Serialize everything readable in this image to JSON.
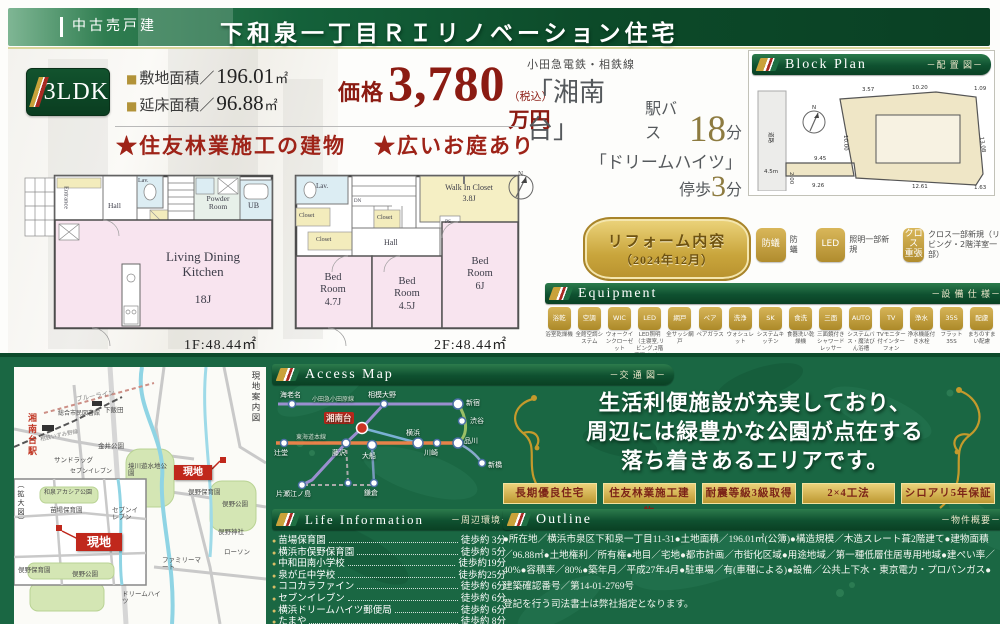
{
  "header": {
    "category": "中古売戸建",
    "title": "下和泉一丁目ＲＩリノベーション住宅"
  },
  "summary": {
    "layout": "3LDK",
    "bullet": "■",
    "land_label": "敷地面積／",
    "land_value": "196.01",
    "land_unit": "㎡",
    "floor_label": "延床面積／",
    "floor_value": "96.88",
    "floor_unit": "㎡",
    "price_label": "価格",
    "price_value": "3,780",
    "price_tax": "（税込）",
    "price_unit": "万円",
    "feature1": "★住友林業施工の建物",
    "feature2": "★広いお庭あり",
    "rail_line": "小田急電鉄・相鉄線",
    "station_name": "「湘南台」",
    "station_mode": "駅バス",
    "station_min": "18",
    "station_unit": "分",
    "bus_name": "「ドリームハイツ」",
    "bus_mode": "停歩",
    "bus_min": "3",
    "bus_unit": "分"
  },
  "block_plan": {
    "title": "Block Plan",
    "subtitle": "－配 置 図－",
    "road": "道路",
    "road_width": "4.5m",
    "compass": "N",
    "dims": {
      "top1": "3.57",
      "top2": "10.20",
      "top3": "1.09",
      "right": "13.08",
      "bottom1": "1.63",
      "bottom2": "12.61",
      "bottom3": "9.26",
      "flag_top": "9.45",
      "flag_left": "2.00",
      "left": "10.00"
    }
  },
  "floor1": {
    "area": "1F:48.44㎡",
    "rooms": {
      "entrance": "Entrance",
      "hall": "Hall",
      "lav": "Lav.",
      "powder": "Powder Room",
      "ub": "UB",
      "ldk": "Living Dining Kitchen",
      "ldk_size": "18J"
    }
  },
  "floor2": {
    "area": "2F:48.44㎡",
    "rooms": {
      "lav": "Lav.",
      "closet1": "Closet",
      "closet2": "Closet",
      "closet3": "Closet",
      "dn": "DN",
      "hall": "Hall",
      "wic": "Walk In Closet",
      "wic_size": "3.8J",
      "ps": "PS",
      "bed1": "Bed Room",
      "bed1_size": "4.7J",
      "bed2": "Bed Room",
      "bed2_size": "4.5J",
      "bed3": "Bed Room",
      "bed3_size": "6J"
    }
  },
  "reform": {
    "badge_title": "リフォーム内容",
    "badge_date": "（2024年12月）",
    "items": [
      {
        "glyph": "防蟻",
        "label": "防蟻"
      },
      {
        "glyph": "LED",
        "label": "照明一部新規"
      },
      {
        "glyph": "クロス 重張",
        "label": "クロス一部新規（リビング・2階洋室一部）"
      }
    ]
  },
  "equipment": {
    "title": "Equipment",
    "subtitle": "－設 備 仕 様－",
    "items": [
      {
        "glyph": "浴乾",
        "label": "浴室乾燥機"
      },
      {
        "glyph": "空調",
        "label": "全館空調システム"
      },
      {
        "glyph": "WIC",
        "label": "ウォークインクローゼット"
      },
      {
        "glyph": "LED",
        "label": "LED照明（主寝室,リビング,2階廊下,トイレ,キッチン,洗面所）"
      },
      {
        "glyph": "網戸",
        "label": "全サッシ網戸"
      },
      {
        "glyph": "ペア",
        "label": "ペアガラス"
      },
      {
        "glyph": "洗浄",
        "label": "ウォシュレット"
      },
      {
        "glyph": "SK",
        "label": "システムキッチン"
      },
      {
        "glyph": "食洗",
        "label": "食器洗い乾燥機"
      },
      {
        "glyph": "三面",
        "label": "三面鏡付きシャワードレッサー"
      },
      {
        "glyph": "AUTO",
        "label": "システムバス・魔法びん浴槽"
      },
      {
        "glyph": "TV",
        "label": "TVモニター付インターフォン"
      },
      {
        "glyph": "浄水",
        "label": "浄水機能付き水栓"
      },
      {
        "glyph": "35S",
        "label": "フラット35S"
      },
      {
        "glyph": "配慮",
        "label": "まちのすまい配慮"
      }
    ]
  },
  "access_map": {
    "title": "Access Map",
    "subtitle": "－交 通 図－",
    "line_labels": {
      "odakyu": "小田急小田原線",
      "tokaido": "東海道本線"
    },
    "stations": {
      "ebina": "海老名",
      "sagamiono": "相模大野",
      "shinjuku": "新宿",
      "shibuya": "渋谷",
      "shonandai": "湘南台",
      "tsujido": "辻堂",
      "fujisawa": "藤沢",
      "ofuna": "大船",
      "yokohama": "横浜",
      "kawasaki": "川崎",
      "shinagawa": "品川",
      "shimbashi": "新橋",
      "katase": "片瀬江ノ島",
      "kamakura": "鎌倉"
    }
  },
  "message": {
    "line1": "生活利便施設が充実しており、",
    "line2": "周辺には緑豊かな公園が点在する",
    "line3": "落ち着きあるエリアです。"
  },
  "cert_badges": [
    "長期優良住宅",
    "住友林業施工建物",
    "耐震等級3級取得",
    "2×4工法",
    "シロアリ5年保証"
  ],
  "life_info": {
    "title": "Life Information",
    "subtitle": "－周辺環境－",
    "items": [
      {
        "name": "苗場保育園",
        "time": "徒歩約 3分"
      },
      {
        "name": "横浜市俣野保育園",
        "time": "徒歩約 5分"
      },
      {
        "name": "中和田南小学校",
        "time": "徒歩約19分"
      },
      {
        "name": "泉が丘中学校",
        "time": "徒歩約25分"
      },
      {
        "name": "ココカラファイン",
        "time": "徒歩約 6分"
      },
      {
        "name": "セブンイレブン",
        "time": "徒歩約 6分"
      },
      {
        "name": "横浜ドリームハイツ郵便局",
        "time": "徒歩約 6分"
      },
      {
        "name": "たまや",
        "time": "徒歩約 8分"
      }
    ]
  },
  "outline": {
    "title": "Outline",
    "subtitle": "－物件概要－",
    "text": "●所在地／横浜市泉区下和泉一丁目11-31●土地面積／196.01㎡(公簿)●構造規模／木造スレート葺2階建て●建物面積／96.88㎡●土地権利／所有権●地目／宅地●都市計画／市街化区域●用途地域／第一種低層住居専用地域●建ぺい率／40%●容積率／80%●築年月／平成27年4月●駐車場／有(車種による)●設備／公共上下水・東京電力・プロパンガス●建築確認番号／第14-01-2769号",
    "note": "登記を行う司法書士は弊社指定となります。"
  },
  "site_map": {
    "guide_label": "現地案内図",
    "inset_label": "（拡大図）",
    "genchi": "現地",
    "labels": {
      "station": "湘南台駅",
      "blueline": "ブルーライン",
      "izumino": "相鉄いずみ野線",
      "shimoiida": "下飯田",
      "library": "総合市民図書館",
      "sundrug": "サンドラッグ",
      "seven1": "セブンイレブン",
      "kanai": "金井公園",
      "sakaigawa": "境川遊水地公園",
      "matano_hoikuen": "俣野保育園",
      "matano_park": "俣野公園",
      "matano_jinja": "俣野神社",
      "lawson": "ローソン",
      "familymart": "ファミリーマート",
      "dream": "ドリームハイツ",
      "acacia": "和泉アカシア公園",
      "naeba": "苗場保育園",
      "seven2": "セブンイレブン",
      "matano_hoikuen2": "俣野保育園",
      "matano_park2": "俣野公園"
    }
  }
}
